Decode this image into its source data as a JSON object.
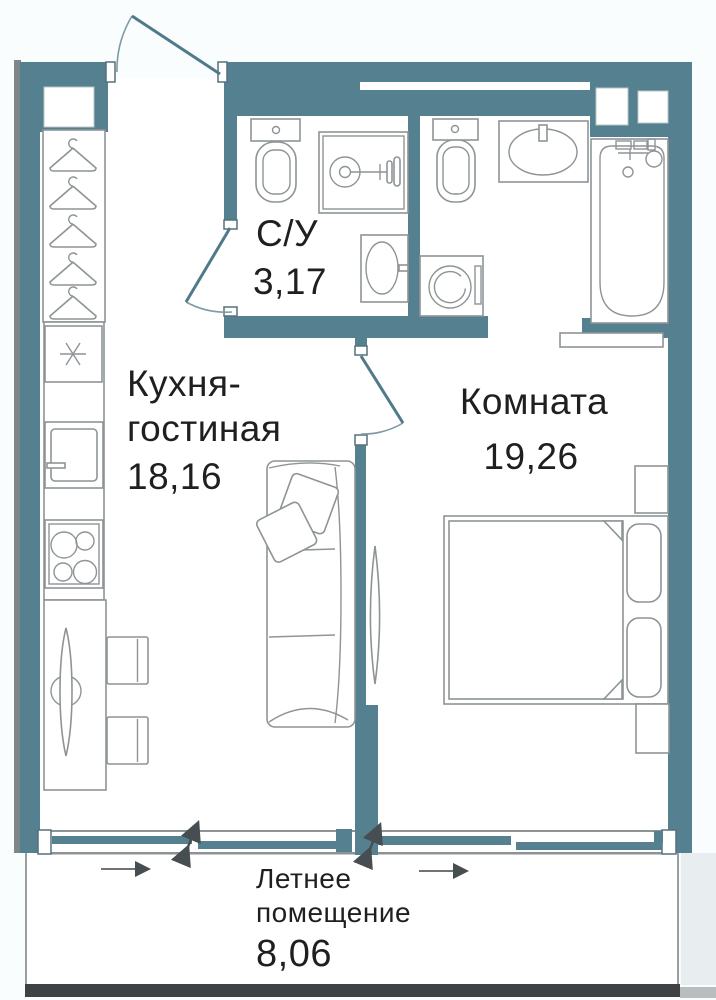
{
  "plan": {
    "type": "apartment-floor-plan",
    "rooms": {
      "bathroom": {
        "name": "С/У",
        "area": "3,17"
      },
      "kitchen_living": {
        "name_line1": "Кухня-",
        "name_line2": "гостиная",
        "area": "18,16"
      },
      "bedroom": {
        "name": "Комната",
        "area": "19,26"
      },
      "summer_room": {
        "name_line1": "Летнее",
        "name_line2": "помещение",
        "area": "8,06"
      }
    },
    "colors": {
      "wall": "#54808F",
      "wall-shadow": "#7E8689",
      "outline": "#8E9496",
      "text": "#1F1F1F",
      "bg": "#FAFDFE",
      "slab": "#3F4245"
    },
    "icons": [
      "entrance-door-icon",
      "hanger-icon",
      "sink-star-icon",
      "fridge-icon",
      "stove-icon",
      "dining-table-icon",
      "chair-icon",
      "sofa-icon",
      "pillow-icon",
      "tv-icon",
      "toilet-icon",
      "shower-icon",
      "washbasin-icon",
      "washing-machine-icon",
      "bathtub-icon",
      "bed-icon",
      "nightstand-icon",
      "sliding-panel-icon",
      "window-handle-icon",
      "direction-arrow-icon"
    ]
  }
}
